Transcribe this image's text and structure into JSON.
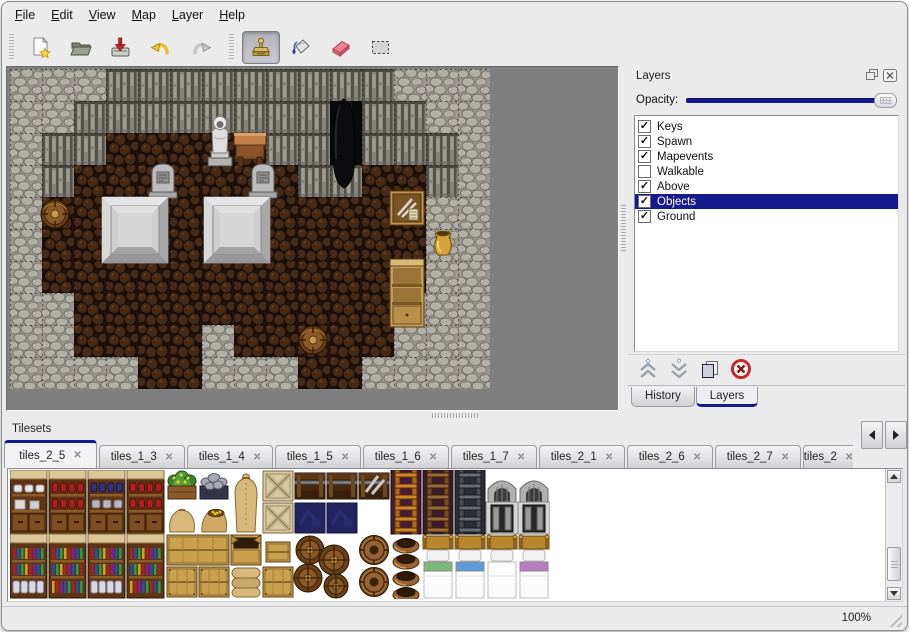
{
  "window": {
    "zoom_status": "100%"
  },
  "colors": {
    "accent_navy": "#151b8c",
    "selection_text": "#ffffff",
    "window_bg": "#ebebeb",
    "viewport_bg": "#7f7f7f",
    "delete_red": "#c62828",
    "undo_yellow": "#e8c22a"
  },
  "menu": {
    "items": [
      "File",
      "Edit",
      "View",
      "Map",
      "Layer",
      "Help"
    ]
  },
  "toolbar": {
    "buttons": [
      {
        "name": "new",
        "icon": "new-file-icon"
      },
      {
        "name": "open",
        "icon": "open-folder-icon"
      },
      {
        "name": "save",
        "icon": "save-import-icon"
      },
      {
        "name": "undo",
        "icon": "undo-icon"
      },
      {
        "name": "redo",
        "icon": "redo-icon"
      },
      {
        "name": "stamp",
        "icon": "stamp-tool-icon",
        "selected": true
      },
      {
        "name": "fill",
        "icon": "fill-bucket-icon"
      },
      {
        "name": "eraser",
        "icon": "eraser-icon"
      },
      {
        "name": "select",
        "icon": "rect-select-icon"
      }
    ]
  },
  "layers_panel": {
    "title": "Layers",
    "opacity_label": "Opacity:",
    "opacity_slider_position": 1.0,
    "layers": [
      {
        "name": "Keys",
        "checked": true,
        "selected": false
      },
      {
        "name": "Spawn",
        "checked": true,
        "selected": false
      },
      {
        "name": "Mapevents",
        "checked": true,
        "selected": false
      },
      {
        "name": "Walkable",
        "checked": false,
        "selected": false
      },
      {
        "name": "Above",
        "checked": true,
        "selected": false
      },
      {
        "name": "Objects",
        "checked": true,
        "selected": true
      },
      {
        "name": "Ground",
        "checked": true,
        "selected": false
      }
    ],
    "buttons": [
      {
        "name": "raise-layer",
        "icon": "chevron-double-up-icon"
      },
      {
        "name": "lower-layer",
        "icon": "chevron-double-down-icon"
      },
      {
        "name": "duplicate-layer",
        "icon": "duplicate-icon"
      },
      {
        "name": "delete-layer",
        "icon": "delete-red-x-icon"
      }
    ],
    "tabs": [
      {
        "label": "History",
        "active": false
      },
      {
        "label": "Layers",
        "active": true
      }
    ]
  },
  "tilesets_panel": {
    "title": "Tilesets",
    "tabs": [
      {
        "label": "tiles_2_5",
        "active": true
      },
      {
        "label": "tiles_1_3"
      },
      {
        "label": "tiles_1_4"
      },
      {
        "label": "tiles_1_5"
      },
      {
        "label": "tiles_1_6"
      },
      {
        "label": "tiles_1_7"
      },
      {
        "label": "tiles_2_1"
      },
      {
        "label": "tiles_2_6"
      },
      {
        "label": "tiles_2_7"
      },
      {
        "label": "tiles_2",
        "truncated": true
      }
    ]
  },
  "map": {
    "tile_size": 32,
    "legend": {
      "P": "pebble-stone",
      "W": "rock-wall",
      "F": "dark-wood-floor",
      "D": "dark-opening"
    },
    "grid": [
      "PPPWWWWWWWWWPPP",
      "PPWWWWWWWWDWWPP",
      "PWWFFFFFWWDWWWP",
      "PWFFFFFFFWWFFWP",
      "PFFFFFFFFFFFFPP",
      "PFFFFFFFFFFFFPP",
      "PFFFFFFFFFFFFPP",
      "PPFFFFFFFFFFPPP",
      "PPFFFFPFFFFFPPP",
      "PPPPFFPPPFFPPPP"
    ],
    "objects": [
      {
        "type": "statue",
        "x": 194,
        "y": 32
      },
      {
        "type": "table",
        "x": 224,
        "y": 62
      },
      {
        "type": "dark-figure",
        "x": 316,
        "y": 28
      },
      {
        "type": "tombstone",
        "x": 137,
        "y": 92
      },
      {
        "type": "tombstone",
        "x": 237,
        "y": 92
      },
      {
        "type": "platform",
        "x": 92,
        "y": 128
      },
      {
        "type": "platform",
        "x": 194,
        "y": 128
      },
      {
        "type": "barrel",
        "x": 30,
        "y": 130
      },
      {
        "type": "crate-tools",
        "x": 380,
        "y": 122
      },
      {
        "type": "vase",
        "x": 420,
        "y": 160
      },
      {
        "type": "shelf",
        "x": 380,
        "y": 190
      },
      {
        "type": "barrel",
        "x": 288,
        "y": 256
      }
    ]
  },
  "tileset_tiles": {
    "items": [
      {
        "type": "shelf-dish",
        "x": 0,
        "y": 0,
        "v": 0
      },
      {
        "type": "shelf-dish",
        "x": 39,
        "y": 0,
        "v": 1
      },
      {
        "type": "shelf-dish",
        "x": 78,
        "y": 0,
        "v": 2
      },
      {
        "type": "shelf-dish",
        "x": 117,
        "y": 0,
        "v": 1
      },
      {
        "type": "planter",
        "x": 156,
        "y": 0,
        "v": 0
      },
      {
        "type": "planter",
        "x": 188,
        "y": 0,
        "v": 1
      },
      {
        "type": "sack-tall",
        "x": 220,
        "y": 0
      },
      {
        "type": "crate-x",
        "x": 252,
        "y": 0
      },
      {
        "type": "chest-dark",
        "x": 284,
        "y": 0,
        "v": 0
      },
      {
        "type": "chest-dark",
        "x": 316,
        "y": 0,
        "v": 0
      },
      {
        "type": "chest-dark",
        "x": 348,
        "y": 0,
        "v": 1
      },
      {
        "type": "ladder",
        "x": 380,
        "y": 0,
        "v": 0
      },
      {
        "type": "ladder",
        "x": 412,
        "y": 0,
        "v": 1
      },
      {
        "type": "ladder",
        "x": 444,
        "y": 0,
        "v": 2
      },
      {
        "type": "arch",
        "x": 476,
        "y": 0
      },
      {
        "type": "arch",
        "x": 508,
        "y": 0
      },
      {
        "type": "sack-big",
        "x": 156,
        "y": 32
      },
      {
        "type": "sack-open",
        "x": 188,
        "y": 32
      },
      {
        "type": "crate-x",
        "x": 252,
        "y": 32
      },
      {
        "type": "navy-tile",
        "x": 284,
        "y": 32
      },
      {
        "type": "navy-tile",
        "x": 316,
        "y": 32
      },
      {
        "type": "shelf-bottle",
        "x": 0,
        "y": 64,
        "v": 0
      },
      {
        "type": "shelf-bottle",
        "x": 39,
        "y": 64,
        "v": 1
      },
      {
        "type": "shelf-bottle",
        "x": 78,
        "y": 64,
        "v": 0
      },
      {
        "type": "shelf-bottle",
        "x": 117,
        "y": 64,
        "v": 1
      },
      {
        "type": "crate-long",
        "x": 156,
        "y": 64
      },
      {
        "type": "crate-open",
        "x": 220,
        "y": 64
      },
      {
        "type": "crate-small",
        "x": 256,
        "y": 72
      },
      {
        "type": "sack-pile",
        "x": 220,
        "y": 96
      },
      {
        "type": "crate-tan",
        "x": 156,
        "y": 96
      },
      {
        "type": "crate-tan",
        "x": 188,
        "y": 96
      },
      {
        "type": "crate-tan",
        "x": 252,
        "y": 96
      },
      {
        "type": "barrel-pile",
        "x": 284,
        "y": 64
      },
      {
        "type": "barrel-big",
        "x": 348,
        "y": 64
      },
      {
        "type": "barrel-big",
        "x": 348,
        "y": 96
      },
      {
        "type": "pots",
        "x": 380,
        "y": 64
      },
      {
        "type": "bed",
        "x": 412,
        "y": 64,
        "v": "green"
      },
      {
        "type": "bed",
        "x": 444,
        "y": 64,
        "v": "blue"
      },
      {
        "type": "bed",
        "x": 476,
        "y": 64,
        "v": "plain"
      },
      {
        "type": "bed",
        "x": 508,
        "y": 64,
        "v": "purple"
      }
    ]
  }
}
